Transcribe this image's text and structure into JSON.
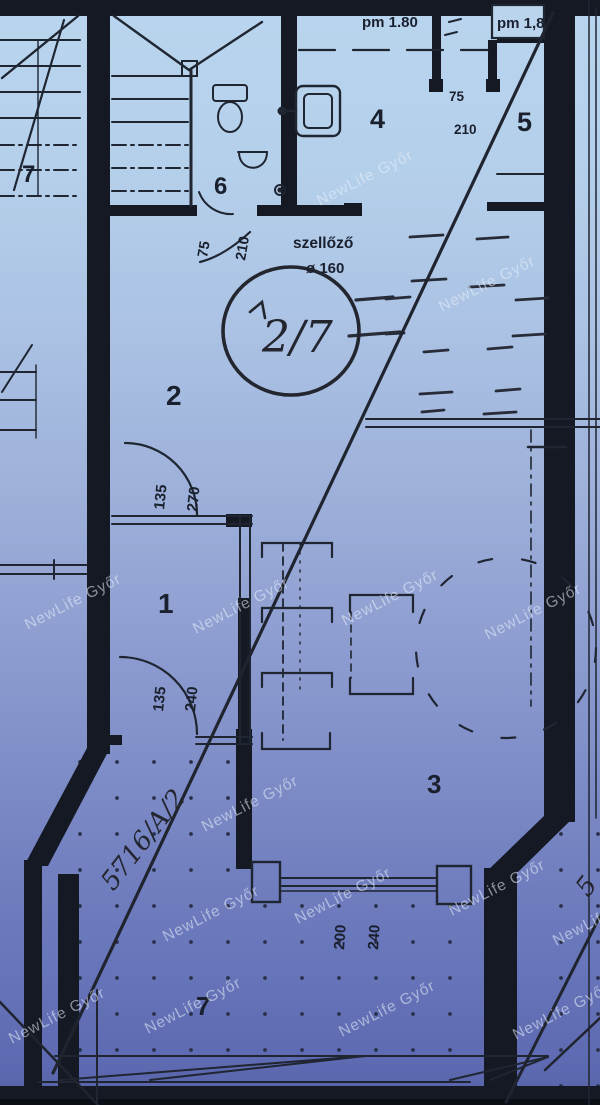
{
  "watermark": "NewLife Győr",
  "plan": {
    "height_marks": {
      "left": "pm 1.80",
      "right": "pm 1,8"
    },
    "vent": {
      "label": "szellőző",
      "size": "ø 160"
    },
    "unit_mark": "2/7",
    "parcel": {
      "number": "5716/A/2",
      "partial": "5"
    },
    "rooms": {
      "stair_top": "7",
      "bath": "6",
      "room4": "4",
      "room5": "5",
      "room2": "2",
      "room1": "1",
      "room3": "3",
      "terrace": "7"
    },
    "dims": {
      "door45": {
        "w": "75",
        "h": "210"
      },
      "door2": {
        "w": "75",
        "h": "210"
      },
      "door1_top": {
        "w": "135",
        "h": "270"
      },
      "door1_bottom": {
        "w": "135",
        "h": "240"
      },
      "terrace_opening": {
        "w": "200",
        "h": "240"
      }
    }
  },
  "colors": {
    "ink": "#1f2531",
    "wall": "#151924",
    "paper_top": "#b9d5ee",
    "paper_bottom": "#5663a8",
    "watermark": "rgba(233,240,249,0.55)"
  }
}
